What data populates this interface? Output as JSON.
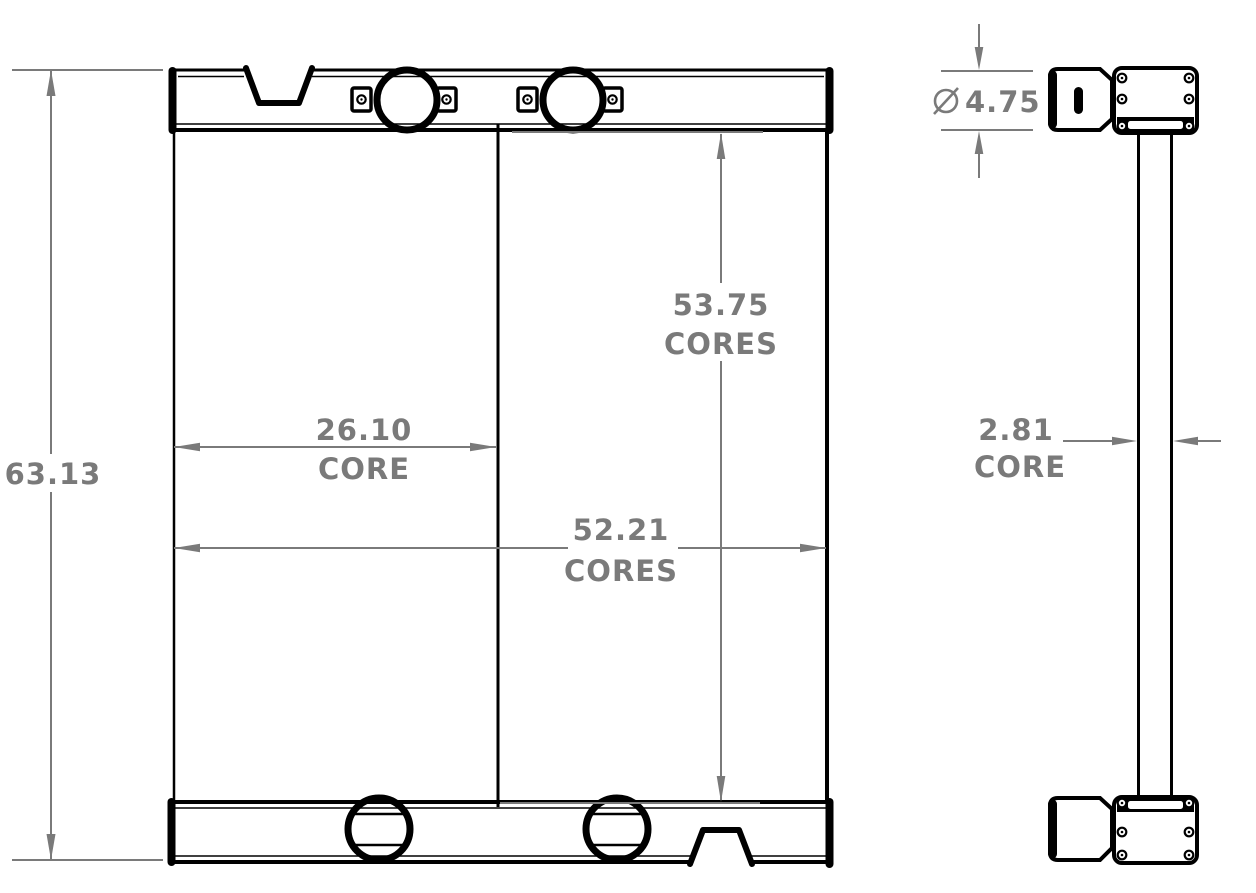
{
  "colors": {
    "line": "#000000",
    "dimension": "#7a7a7a",
    "background": "#ffffff"
  },
  "dimensions": {
    "overall_height": {
      "value": "63.13"
    },
    "core_width": {
      "value": "26.10",
      "label": "CORE"
    },
    "cores_width": {
      "value": "52.21",
      "label": "CORES"
    },
    "cores_height": {
      "value": "53.75",
      "label": "CORES"
    },
    "inlet_diameter": {
      "value": "4.75",
      "symbol": "⌀",
      "symbol_icon": "diameter-icon"
    },
    "core_depth": {
      "value": "2.81",
      "label": "CORE"
    }
  }
}
